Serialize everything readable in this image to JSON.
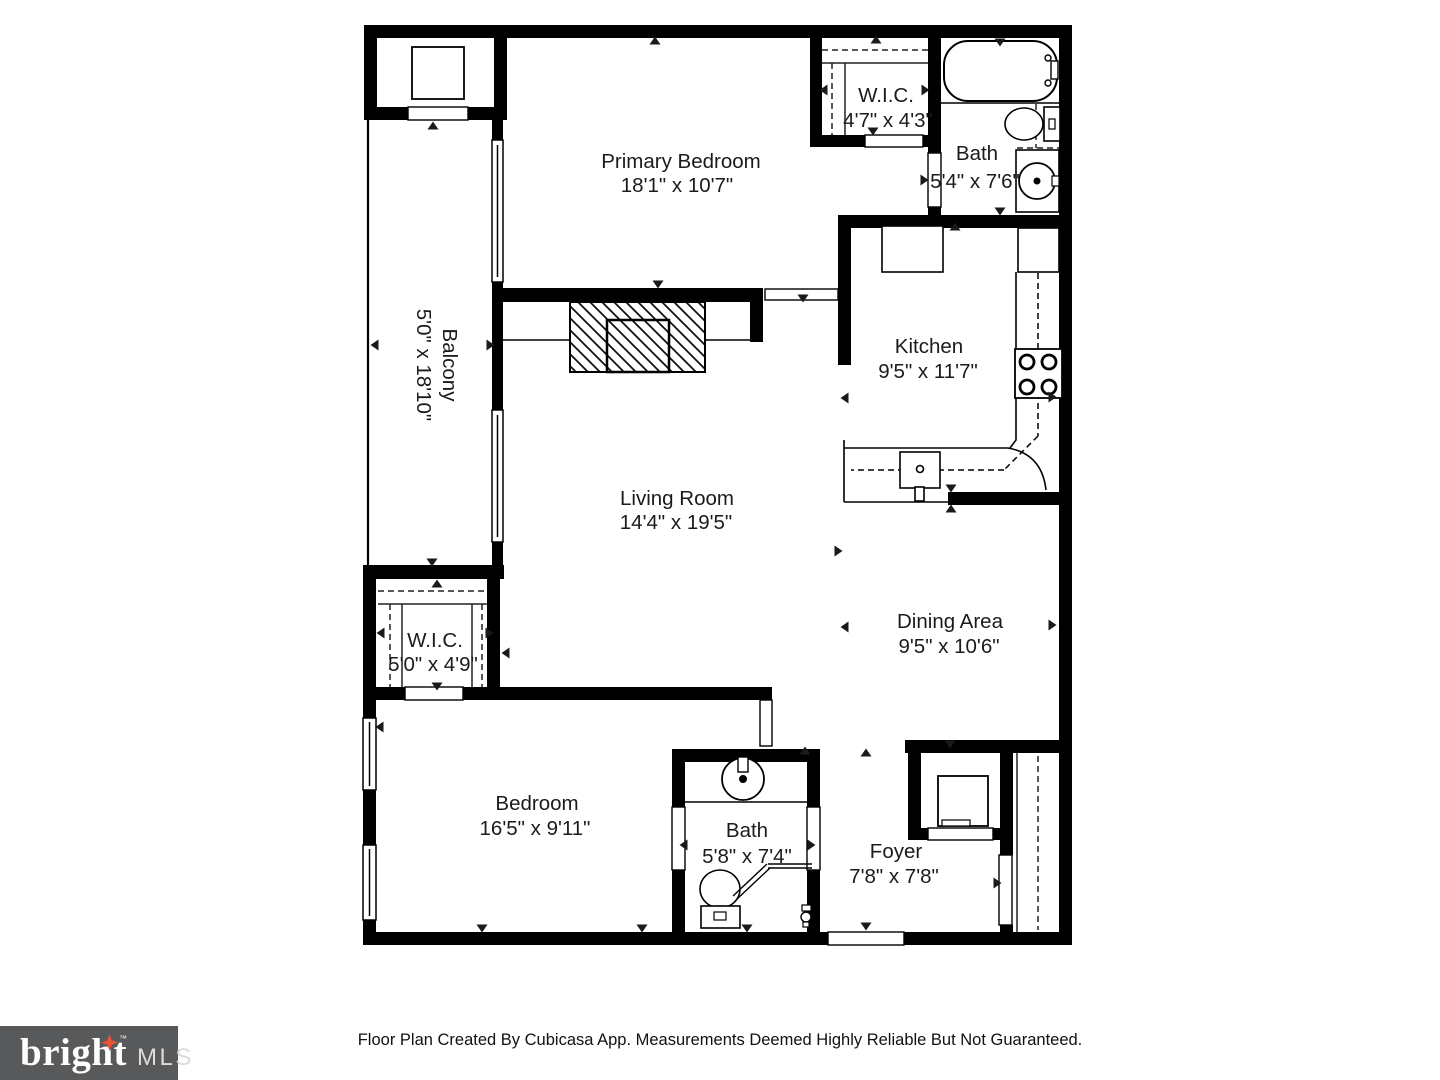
{
  "rooms": {
    "primary_bedroom": {
      "name": "Primary Bedroom",
      "dims": "18'1\" x 10'7\""
    },
    "wic_upper": {
      "name": "W.I.C.",
      "dims": "4'7\" x 4'3\""
    },
    "bath_upper": {
      "name": "Bath",
      "dims": "5'4\" x 7'6\""
    },
    "balcony": {
      "name": "Balcony",
      "dims": "5'0\" x 18'10\""
    },
    "kitchen": {
      "name": "Kitchen",
      "dims": "9'5\" x 11'7\""
    },
    "living_room": {
      "name": "Living Room",
      "dims": "14'4\" x 19'5\""
    },
    "dining_area": {
      "name": "Dining Area",
      "dims": "9'5\" x 10'6\""
    },
    "wic_lower": {
      "name": "W.I.C.",
      "dims": "5'0\" x 4'9\""
    },
    "bedroom": {
      "name": "Bedroom",
      "dims": "16'5\" x 9'11\""
    },
    "bath_lower": {
      "name": "Bath",
      "dims": "5'8\" x 7'4\""
    },
    "foyer": {
      "name": "Foyer",
      "dims": "7'8\" x 7'8\""
    }
  },
  "footer": {
    "credit": "Floor Plan Created By Cubicasa App. Measurements Deemed Highly Reliable But Not Guaranteed."
  },
  "logo": {
    "brand": "bright",
    "tm": "™",
    "suffix": "MLS"
  },
  "colors": {
    "wall": "#000000",
    "label_text": "#1b1b1b",
    "logo_background": "#58595b",
    "logo_star": "#e8543a"
  }
}
